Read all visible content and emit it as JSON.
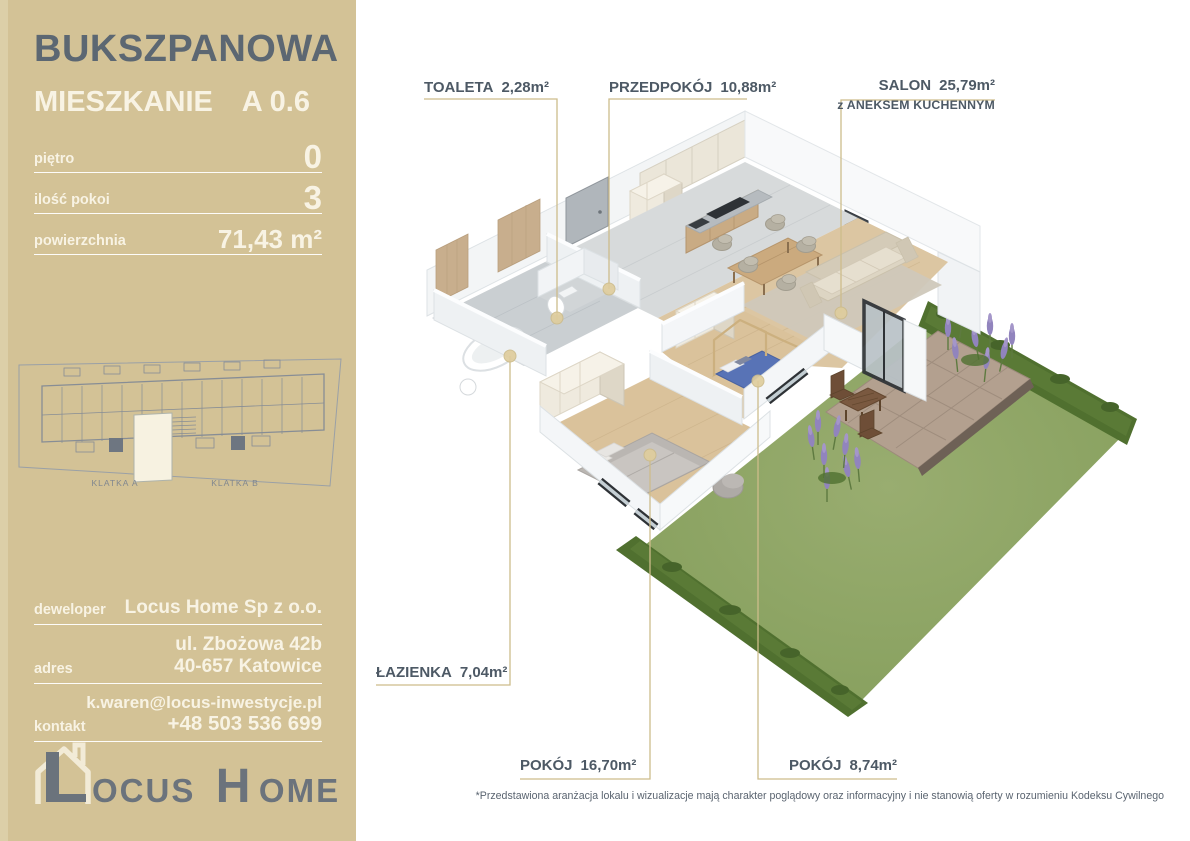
{
  "sidebar": {
    "project": "BUKSZPANOWA",
    "unit_label": "MIESZKANIE",
    "unit_number": "A 0.6",
    "stats": [
      {
        "label": "piętro",
        "value": "0"
      },
      {
        "label": "ilość pokoi",
        "value": "3"
      },
      {
        "label": "powierzchnia",
        "value": "71,43 m²"
      }
    ],
    "sitemap": {
      "klatka_a": "KLATKA A",
      "klatka_b": "KLATKA B"
    },
    "contact": {
      "developer_label": "deweloper",
      "developer_value": "Locus Home Sp z o.o.",
      "address_label": "adres",
      "address_line1": "ul. Zbożowa 42b",
      "address_line2": "40-657 Katowice",
      "contact_label": "kontakt",
      "contact_email": "k.waren@locus-inwestycje.pl",
      "contact_phone": "+48 503 536 699"
    },
    "logo": {
      "rest1": "OCUS",
      "initial2": "H",
      "rest2": "OME"
    }
  },
  "plan": {
    "rooms": [
      {
        "name": "TOALETA",
        "area": "2,28m²"
      },
      {
        "name": "PRZEDPOKÓJ",
        "area": "10,88m²"
      },
      {
        "name": "SALON",
        "area": "25,79m²",
        "subtitle": "z ANEKSEM KUCHENNYM"
      },
      {
        "name": "ŁAZIENKA",
        "area": "7,04m²"
      },
      {
        "name": "POKÓJ",
        "area": "16,70m²"
      },
      {
        "name": "POKÓJ",
        "area": "8,74m²"
      }
    ]
  },
  "footer": {
    "disclaimer": "*Przedstawiona aranżacja lokalu i wizualizacje mają charakter poglądowy oraz informacyjny i nie stanowią oferty w rozumieniu Kodeksu Cywilnego"
  },
  "colors": {
    "sidebar": "#d3c296",
    "title": "#5c6772",
    "cream": "#f8f3e4",
    "label": "#4d5965",
    "leader": "#cdbc8b",
    "lawn": "#8fa768",
    "hedge": "#50702f",
    "deck": "#b3a08f"
  }
}
